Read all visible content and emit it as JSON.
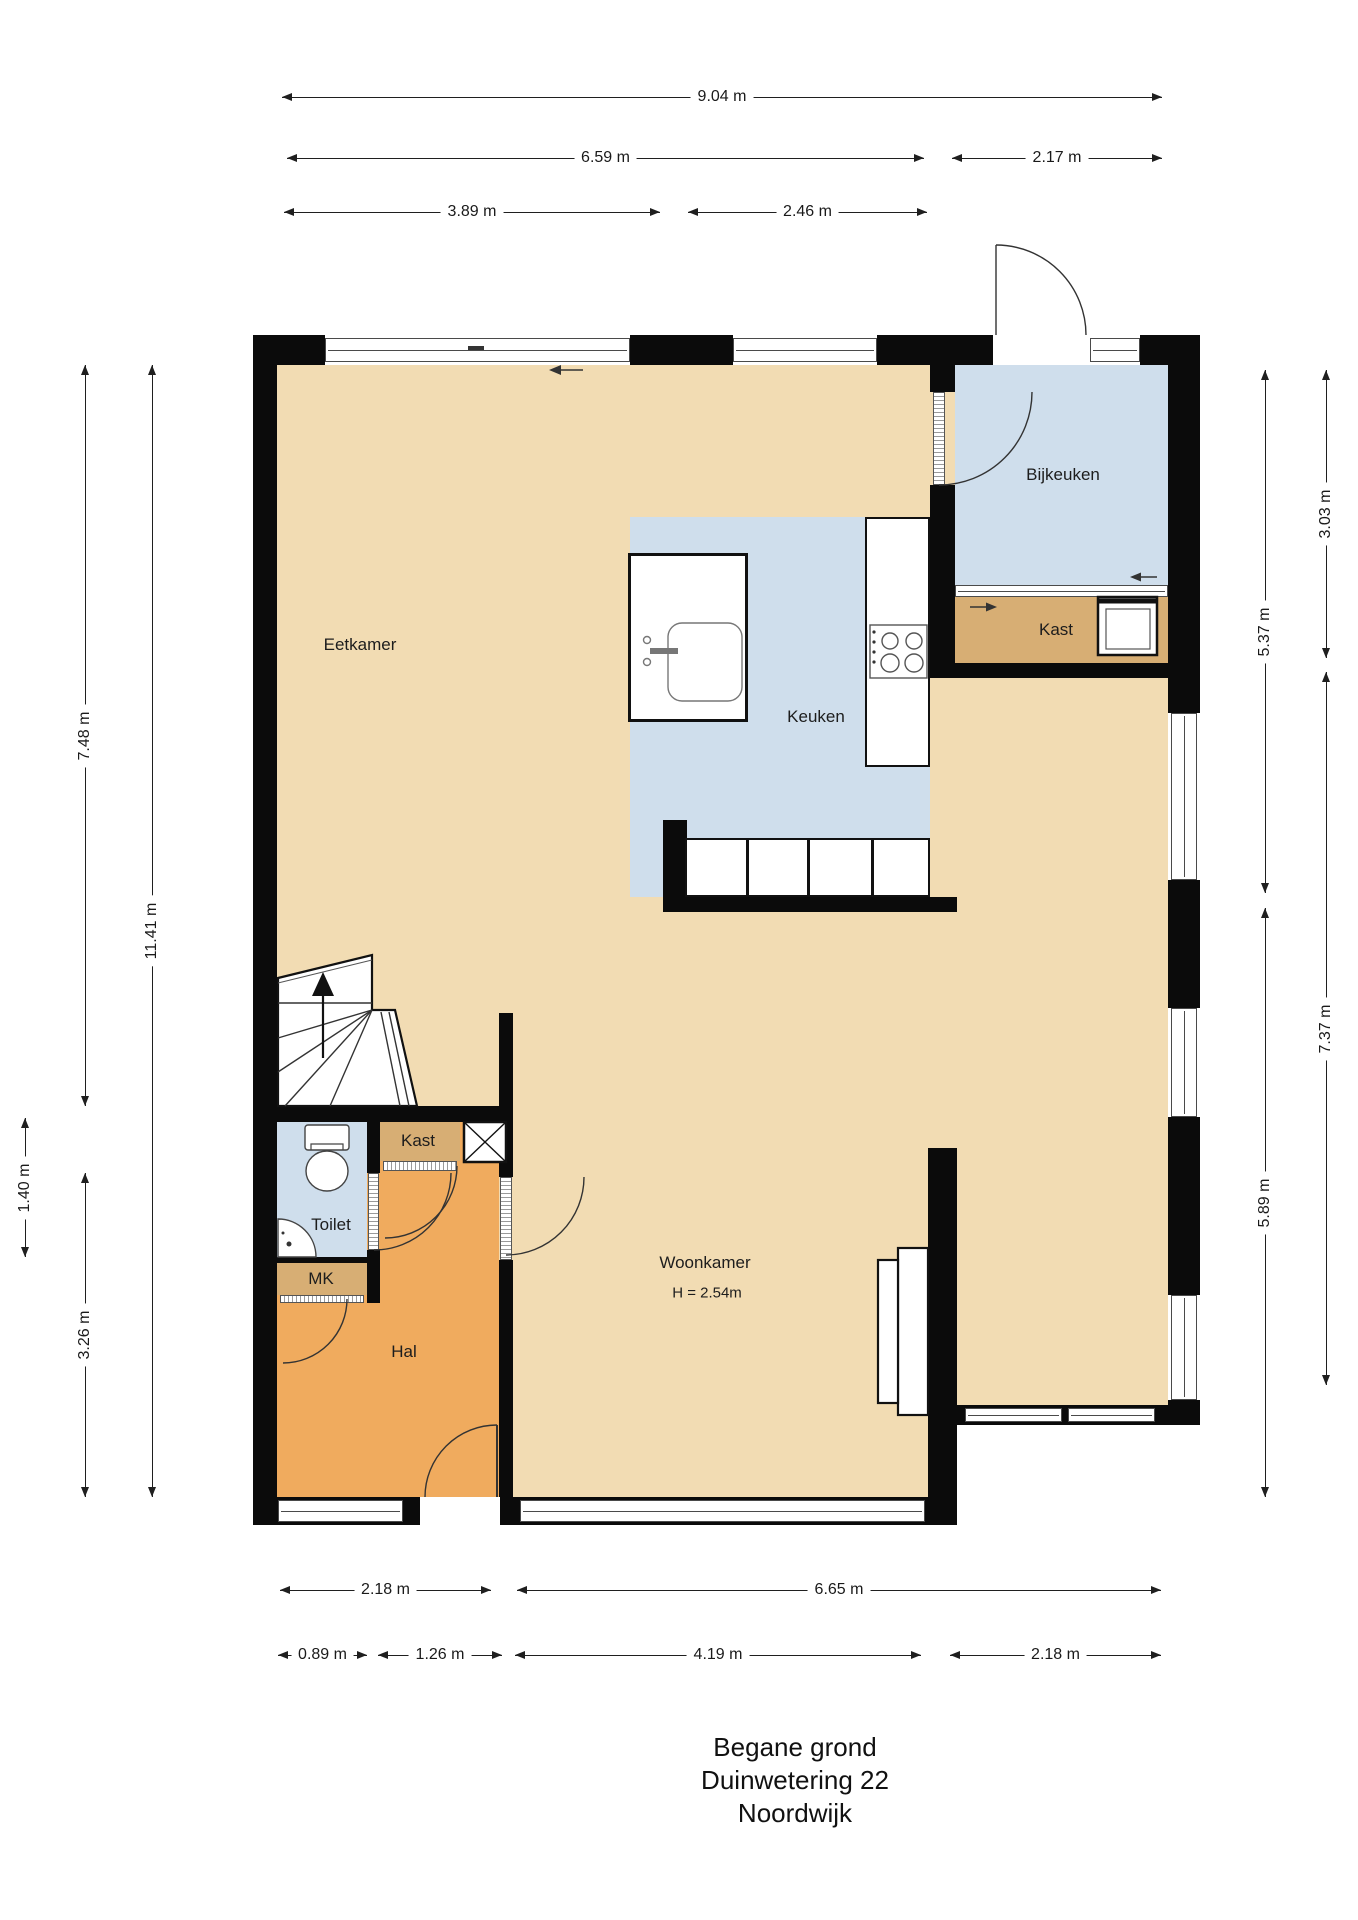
{
  "title": {
    "floor": "Begane grond",
    "address": "Duinwetering 22",
    "city": "Noordwijk"
  },
  "rooms": {
    "eetkamer": "Eetkamer",
    "keuken": "Keuken",
    "bijkeuken": "Bijkeuken",
    "kast_bijkeuken": "Kast",
    "kast_hal": "Kast",
    "toilet": "Toilet",
    "meterkast": "MK",
    "hal": "Hal",
    "woonkamer": "Woonkamer",
    "woonkamer_ceiling_height": "H = 2.54m"
  },
  "dimensions": {
    "top": [
      "9.04 m",
      "6.59 m",
      "2.17 m",
      "3.89 m",
      "2.46 m"
    ],
    "bottom": [
      "2.18 m",
      "6.65 m",
      "0.89 m",
      "1.26 m",
      "4.19 m",
      "2.18 m"
    ],
    "left": [
      "7.48 m",
      "11.41 m",
      "1.40 m",
      "3.26 m"
    ],
    "right": [
      "3.03 m",
      "5.37 m",
      "7.37 m",
      "5.89 m"
    ]
  },
  "colors": {
    "floor": "#f2dcb3",
    "hall_floor": "#f0ab5e",
    "closet_floor": "#d7ae74",
    "wet_floor": "#cfdeec",
    "wall": "#0b0b0b"
  }
}
